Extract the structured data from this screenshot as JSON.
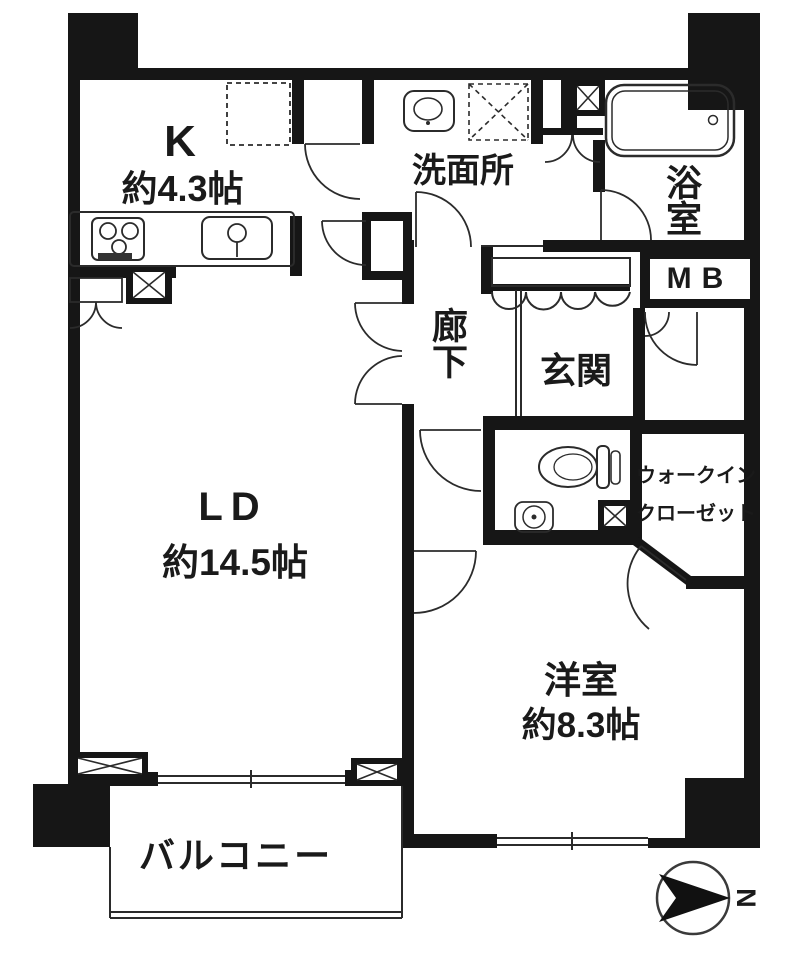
{
  "colors": {
    "wall": "#161616",
    "line": "#2b2b2b",
    "background": "#ffffff"
  },
  "rooms": {
    "kitchen": {
      "label": "K",
      "size": "約4.3帖"
    },
    "washroom": {
      "label": "洗面所"
    },
    "bathroom": {
      "label": "浴室"
    },
    "meter_box": {
      "label": "MB"
    },
    "corridor": {
      "label": "廊下"
    },
    "entrance": {
      "label": "玄関"
    },
    "living_dining": {
      "label": "LD",
      "size": "約14.5帖"
    },
    "western_room": {
      "label": "洋室",
      "size": "約8.3帖"
    },
    "walk_in_closet": {
      "line1": "ウォークイン",
      "line2": "クローゼット"
    },
    "balcony": {
      "label": "バルコニー"
    }
  },
  "compass": {
    "north_label": "N"
  },
  "fixtures": {
    "stove_icon": "gas-stove",
    "kitchen_sink_icon": "kitchen-sink",
    "refrigerator_space": "dashed-outline",
    "washer_space": "dashed-outline-x",
    "vanity_sink_icon": "washroom-sink",
    "bathtub_icon": "bathtub",
    "toilet_icon": "toilet",
    "toilet_sink_icon": "round-basin",
    "compass_icon": "north-arrow"
  }
}
